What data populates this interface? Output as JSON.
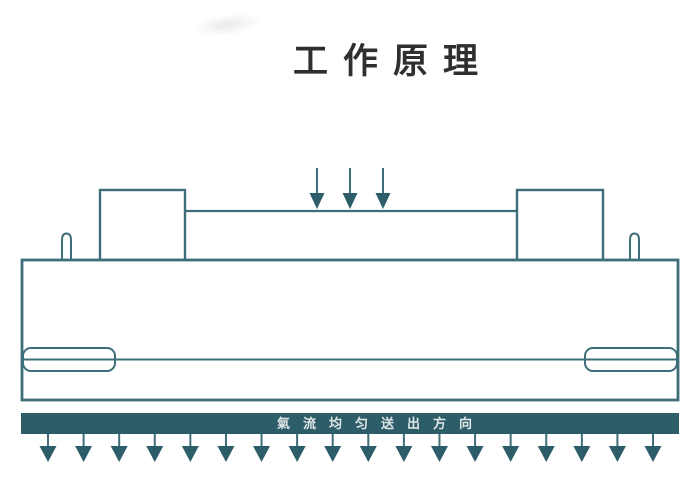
{
  "title": "工作原理",
  "diagram": {
    "airflow_label": "氣流均匀送出方向",
    "top_arrows": {
      "count": 3,
      "center_x": 350,
      "spacing": 33
    },
    "bottom_arrows": {
      "count": 18,
      "start_x": 48,
      "end_x": 653
    }
  },
  "colors": {
    "outline": "#3e6e79",
    "dark_fill": "#2c5d69",
    "title_text": "#2f2f2f",
    "bar_text": "#dfe6e6",
    "background": "#ffffff"
  }
}
